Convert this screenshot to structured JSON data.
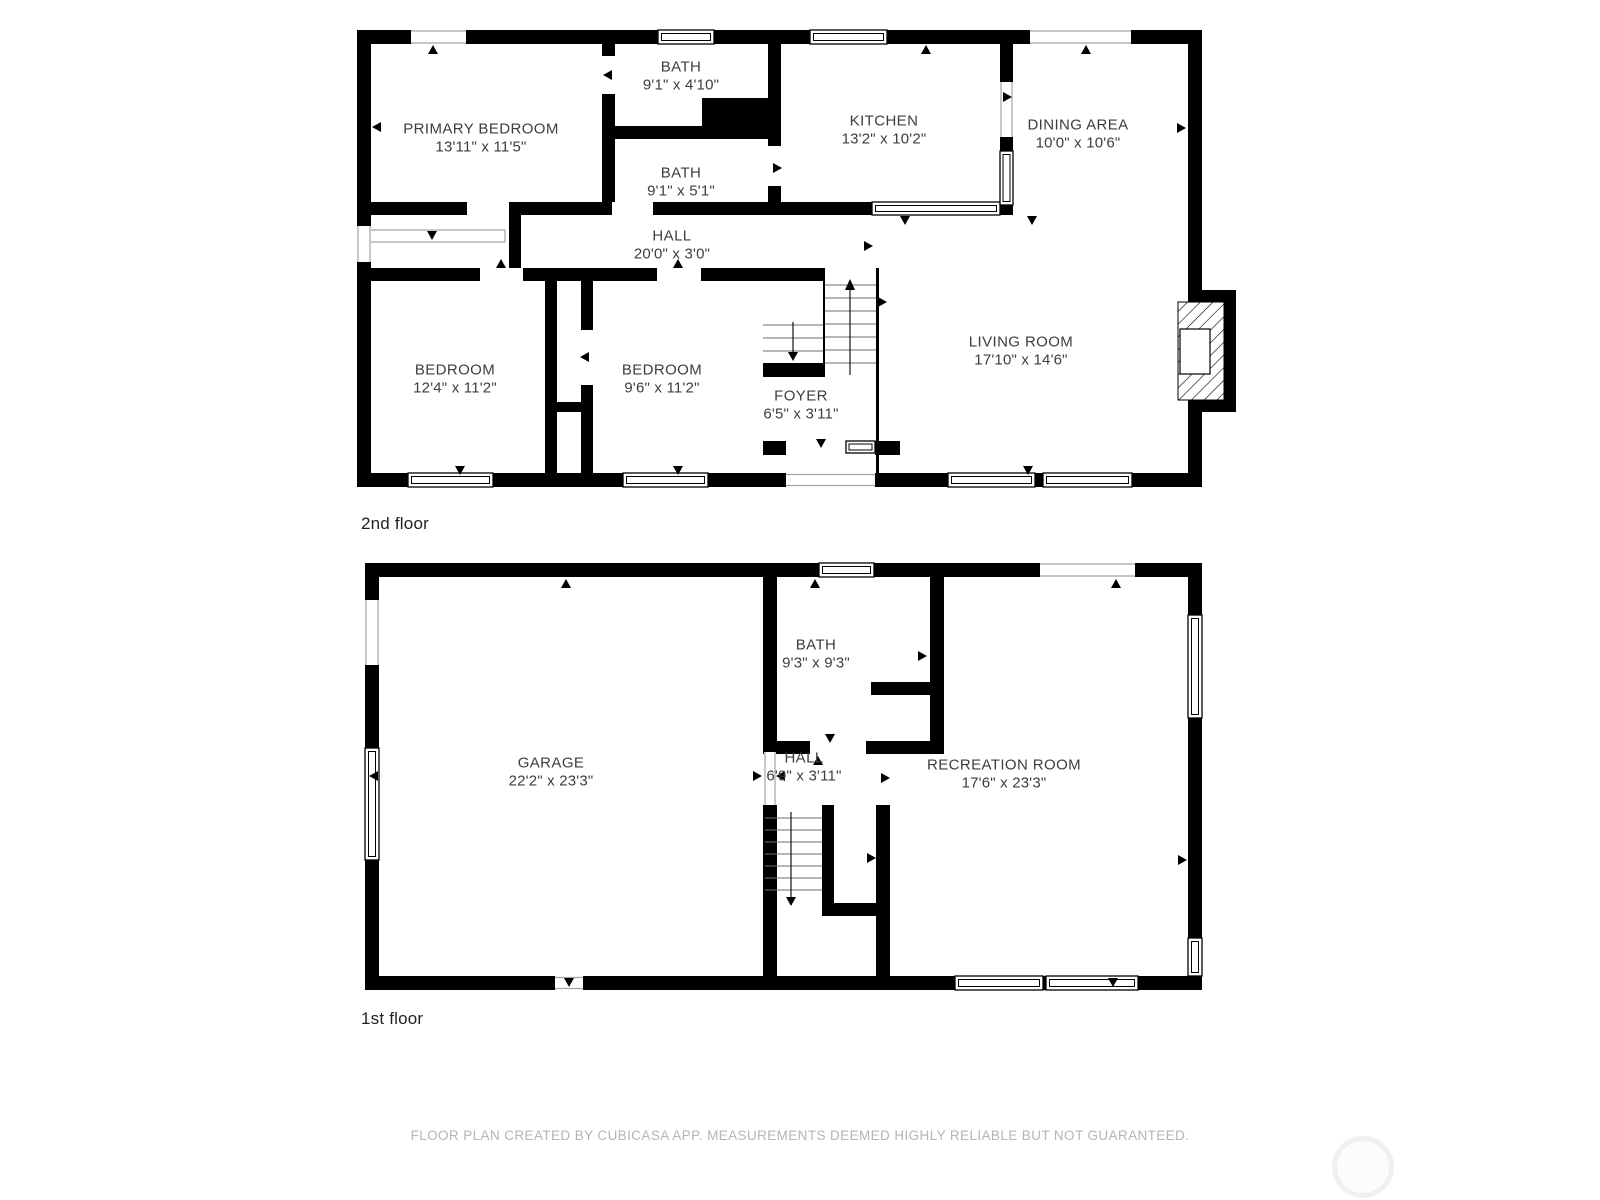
{
  "floors": [
    {
      "label": "2nd floor",
      "rooms": [
        {
          "name": "PRIMARY BEDROOM",
          "dims": "13'11\" x 11'5\""
        },
        {
          "name": "BATH",
          "dims": "9'1\" x 4'10\""
        },
        {
          "name": "KITCHEN",
          "dims": "13'2\" x 10'2\""
        },
        {
          "name": "DINING AREA",
          "dims": "10'0\" x 10'6\""
        },
        {
          "name": "BATH",
          "dims": "9'1\" x 5'1\""
        },
        {
          "name": "HALL",
          "dims": "20'0\" x 3'0\""
        },
        {
          "name": "BEDROOM",
          "dims": "12'4\" x 11'2\""
        },
        {
          "name": "BEDROOM",
          "dims": "9'6\" x 11'2\""
        },
        {
          "name": "FOYER",
          "dims": "6'5\" x 3'11\""
        },
        {
          "name": "LIVING ROOM",
          "dims": "17'10\" x 14'6\""
        }
      ]
    },
    {
      "label": "1st floor",
      "rooms": [
        {
          "name": "GARAGE",
          "dims": "22'2\" x 23'3\""
        },
        {
          "name": "BATH",
          "dims": "9'3\" x 9'3\""
        },
        {
          "name": "HALL",
          "dims": "6'9\" x 3'11\""
        },
        {
          "name": "RECREATION ROOM",
          "dims": "17'6\" x 23'3\""
        }
      ]
    }
  ],
  "footer": {
    "text": "FLOOR PLAN CREATED BY CUBICASA APP. MEASUREMENTS DEEMED HIGHLY RELIABLE BUT NOT GUARANTEED."
  },
  "colors": {
    "wall": "#000000",
    "room_label": "#3d3d3d",
    "floor_label": "#222222",
    "footer_text": "#b5b5b5",
    "watermark_ring": "#f0f0f0"
  }
}
